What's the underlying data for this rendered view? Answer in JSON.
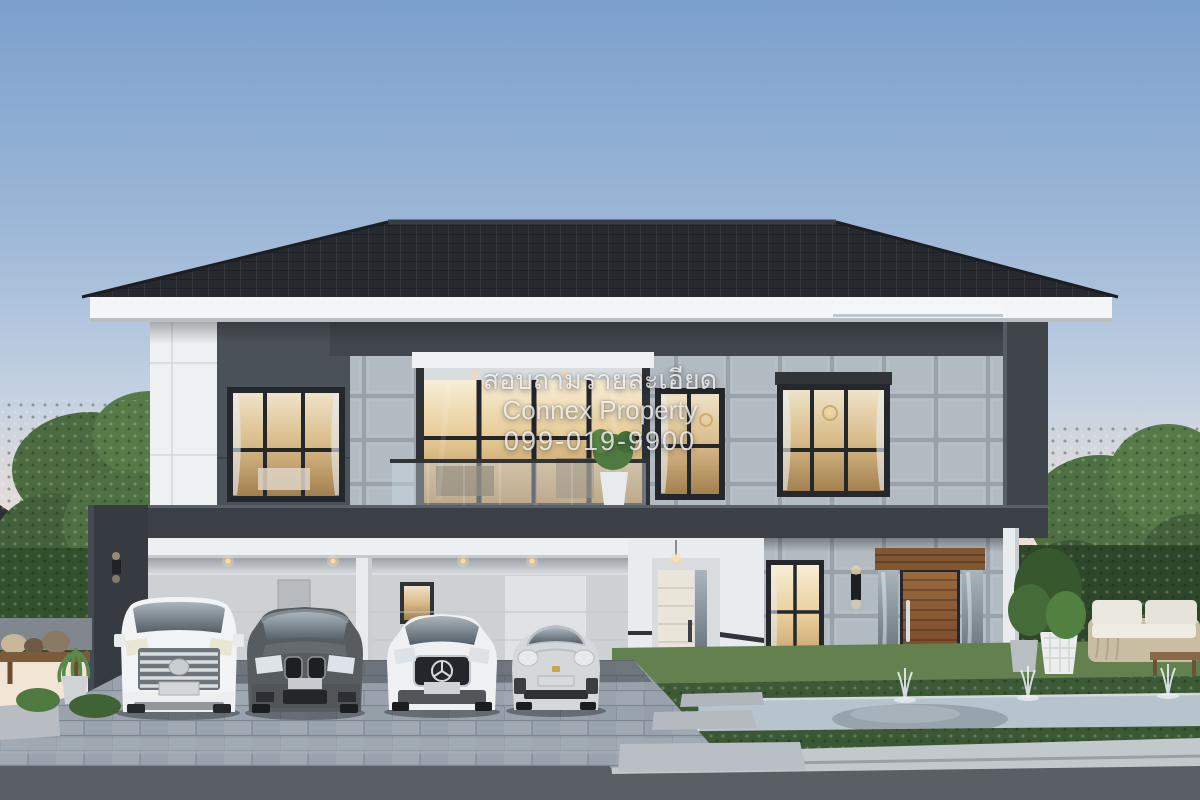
{
  "image": {
    "type": "3d-architectural-rendering",
    "subject": "Modern two-storey luxury house at dusk with carport, four parked cars, landscaped garden and fountain pond"
  },
  "watermark": {
    "line1": "สอบถามรายละเอียด",
    "line2": "Connex Property",
    "line3": "099-019-9900",
    "text_color": "#ffffff"
  },
  "scene": {
    "sky": {
      "top_color": "#7ba0cc",
      "horizon_color": "#f3e4d4"
    },
    "house": {
      "roof_color": "#26292d",
      "fascia_color": "#f3f5f7",
      "upper_band_color": "#41474d",
      "dark_panel_color": "#4b5158",
      "white_wall_color": "#eef0f2",
      "stone_wall_color": "#b3bbc2",
      "floor_band_color": "#3a4046",
      "window_frame_color": "#24282c",
      "window_glow_color": "#ecd9ae",
      "wood_door_color": "#8a5a36",
      "second_floor_windows": 4,
      "balcony_style": "glass-railing",
      "carport_downlights": 4
    },
    "cars": [
      {
        "name": "white-luxury-van",
        "color": "#f1f3f4"
      },
      {
        "name": "dark-gray-suv",
        "color": "#575c61"
      },
      {
        "name": "white-sedan",
        "color": "#eef0f2"
      },
      {
        "name": "silver-sports-coupe",
        "color": "#d4d8db"
      }
    ],
    "landscape": {
      "lawn_color": "#63804f",
      "hedge_color": "#3c5a36",
      "tree_color": "#4f7042",
      "pond_color": "#b7c4cd",
      "paver_color": "#9aa3ad",
      "road_color": "#5a5f66",
      "fountain_jets": 3
    }
  }
}
